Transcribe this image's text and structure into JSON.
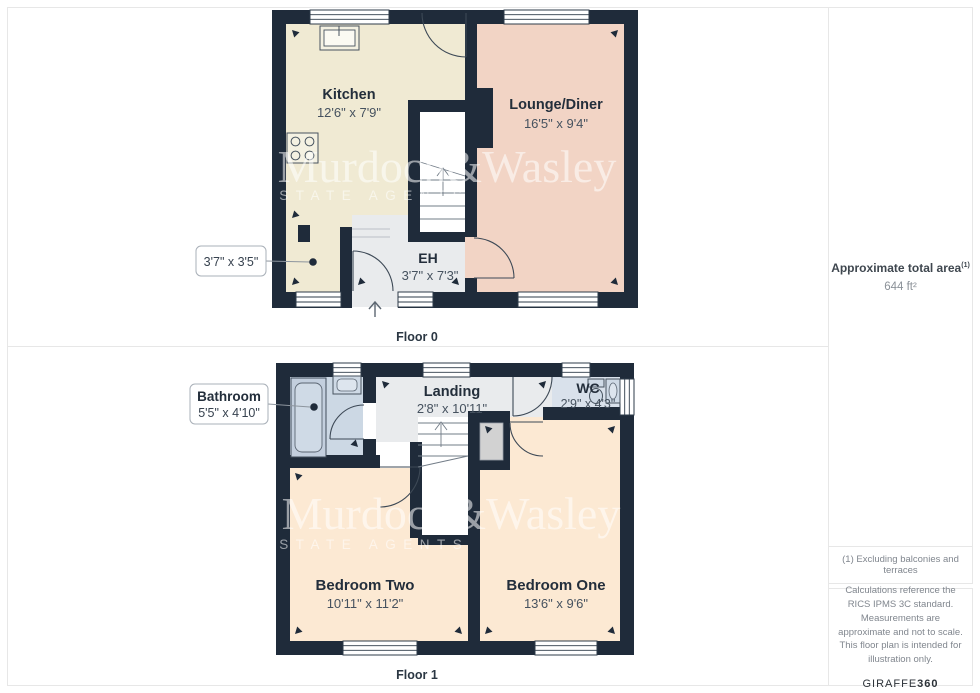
{
  "floor0": {
    "caption": "Floor 0",
    "rooms": {
      "kitchen": {
        "name": "Kitchen",
        "dims": "12'6\" x 7'9\""
      },
      "lounge": {
        "name": "Lounge/Diner",
        "dims": "16'5\" x 9'4\""
      },
      "eh": {
        "name": "EH",
        "dims": "3'7\" x 7'3\""
      }
    },
    "callout": {
      "dims": "3'7\" x 3'5\""
    }
  },
  "floor1": {
    "caption": "Floor 1",
    "rooms": {
      "landing": {
        "name": "Landing",
        "dims": "2'8\" x 10'11\""
      },
      "wc": {
        "name": "WC",
        "dims": "2'9\" x 4'3\""
      },
      "bedroom_two": {
        "name": "Bedroom Two",
        "dims": "10'11\" x 11'2\""
      },
      "bedroom_one": {
        "name": "Bedroom One",
        "dims": "13'6\" x 9'6\""
      }
    },
    "callout": {
      "name": "Bathroom",
      "dims": "5'5\" x 4'10\""
    }
  },
  "watermark": {
    "line1": "Murdoch&Wasley",
    "line2": "ESTATE AGENTS"
  },
  "sidebar": {
    "area_label": "Approximate total area",
    "area_note_ref": "(1)",
    "area_value": "644 ft²",
    "footnote": "(1) Excluding balconies and terraces",
    "disclaimer": "Calculations reference the RICS IPMS 3C standard. Measurements are approximate and not to scale. This floor plan is intended for illustration only.",
    "brand_name": "GIRAFFE",
    "brand_number": "360"
  },
  "colors": {
    "wall": "#1f2b3a",
    "kitchen": "#f0ead3",
    "lounge": "#f2d4c5",
    "hall": "#e9ebed",
    "bedroom": "#fce9d3",
    "bathroom": "#ccd8e4",
    "wc": "#d9e1eb",
    "closet": "#d2d2d2",
    "card_border": "#e7e7e7"
  }
}
